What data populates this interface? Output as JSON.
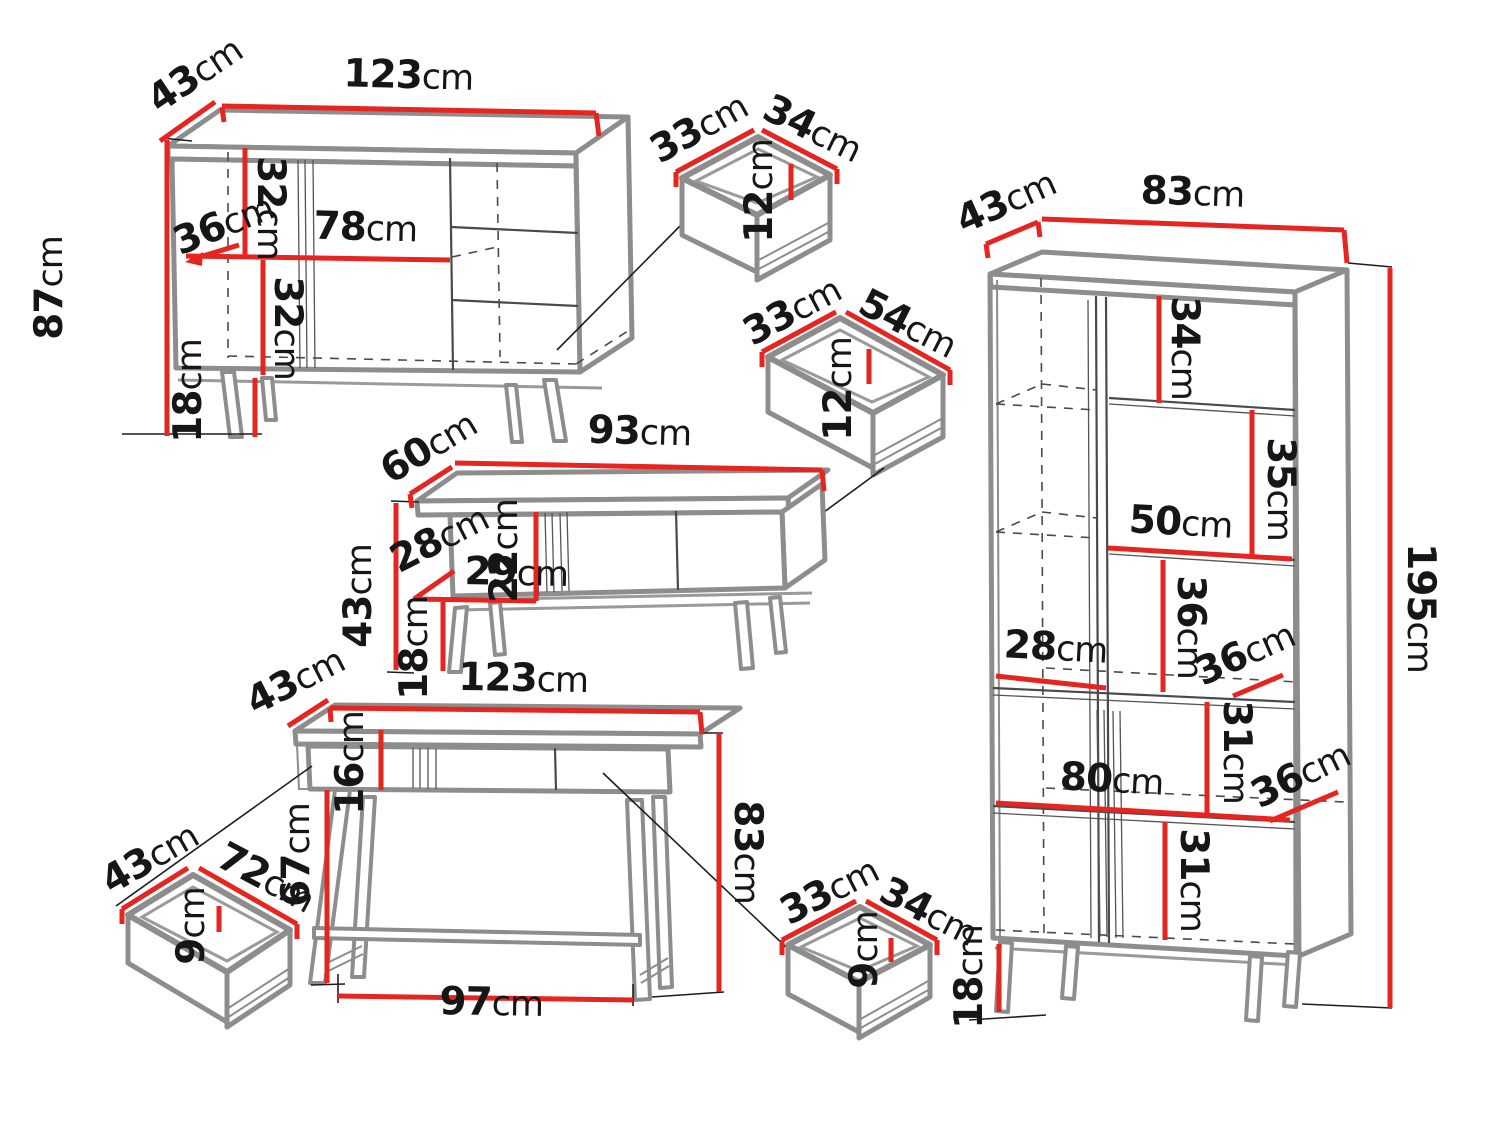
{
  "unit": "cm",
  "colors": {
    "dimension_line": "#e62420",
    "furniture_outline": "#8d8d8d",
    "detail_line": "#1d1d1d",
    "background": "#ffffff"
  },
  "pieces": {
    "sideboard": {
      "labels": {
        "depth": "43",
        "width": "123",
        "height": "87",
        "inner_depth": "36",
        "upper_section": "32",
        "inner_width": "78",
        "lower_section": "32",
        "leg_height": "18"
      }
    },
    "drawer_a": {
      "labels": {
        "depth": "33",
        "width": "34",
        "height": "12"
      }
    },
    "drawer_b": {
      "labels": {
        "depth": "33",
        "width": "54",
        "height": "12"
      }
    },
    "coffee_table": {
      "labels": {
        "depth": "60",
        "width": "93",
        "height": "43",
        "niche_depth": "28",
        "niche_height": "22",
        "niche_width": "29",
        "leg_height": "18"
      }
    },
    "console_table": {
      "labels": {
        "depth": "43",
        "width": "123",
        "drawer_height": "16",
        "leg_height": "67",
        "height": "83",
        "base_width": "97"
      }
    },
    "drawer_c": {
      "labels": {
        "depth": "43",
        "width": "72",
        "height": "9"
      }
    },
    "drawer_d": {
      "labels": {
        "depth": "33",
        "width": "34",
        "height": "9"
      }
    },
    "bookcase": {
      "labels": {
        "depth": "43",
        "width": "83",
        "compartment_1": "34",
        "compartment_2": "35",
        "inner_width_right": "50",
        "compartment_3": "36",
        "inner_width_left": "28",
        "shelf_depth_mid": "36",
        "compartment_4": "31",
        "inner_width_full": "80",
        "shelf_depth_low": "36",
        "compartment_5": "31",
        "height": "195",
        "leg_height": "18"
      }
    }
  }
}
